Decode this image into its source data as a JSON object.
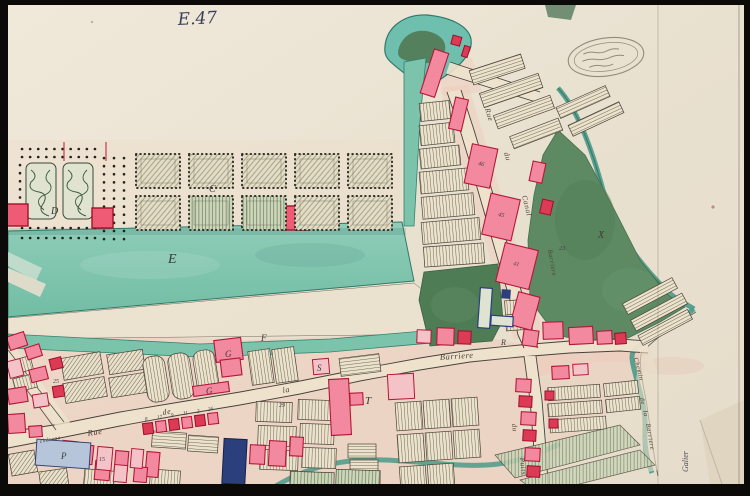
{
  "document": {
    "type": "historical manuscript town plan, watercolor on paper, photographed slide",
    "sheet_number": "E.47",
    "corner_inscription": "Galier"
  },
  "stamp": {
    "shape": "oval",
    "legible": false
  },
  "labels": {
    "areas": [
      {
        "letter": "D"
      },
      {
        "letter": "C"
      },
      {
        "letter": "E"
      },
      {
        "letter": "F"
      },
      {
        "letter": "G"
      },
      {
        "letter": "G"
      },
      {
        "letter": "S"
      },
      {
        "letter": "T"
      },
      {
        "letter": "R"
      },
      {
        "letter": "P"
      },
      {
        "letter": "X"
      }
    ],
    "streets": [
      {
        "text": "Rue"
      },
      {
        "text": "de"
      },
      {
        "text": "la"
      },
      {
        "text": "Barriere"
      },
      {
        "text": "Rue"
      },
      {
        "text": "du"
      },
      {
        "text": "Canal"
      },
      {
        "text": "Barriere"
      },
      {
        "text": "du"
      },
      {
        "text": "Puits"
      },
      {
        "text": "Chemin"
      },
      {
        "text": "de"
      },
      {
        "text": "la"
      },
      {
        "text": "Barriere"
      },
      {
        "text": "château"
      }
    ],
    "plot_numbers": [
      "46",
      "45",
      "41",
      "23",
      "29",
      "15",
      "25",
      "8",
      "17",
      "9",
      "11",
      "2",
      "26"
    ]
  },
  "colors": {
    "water": "#79c2ab",
    "water_edge": "#2f7a6b",
    "field_green": "#5d8a63",
    "building_pink": "#f2899e",
    "building_red": "#dc3a55",
    "building_navy": "#2c3f7d",
    "urban_wash": "#efc9ba",
    "paper": "#eae2d1",
    "ink": "#48423a"
  }
}
